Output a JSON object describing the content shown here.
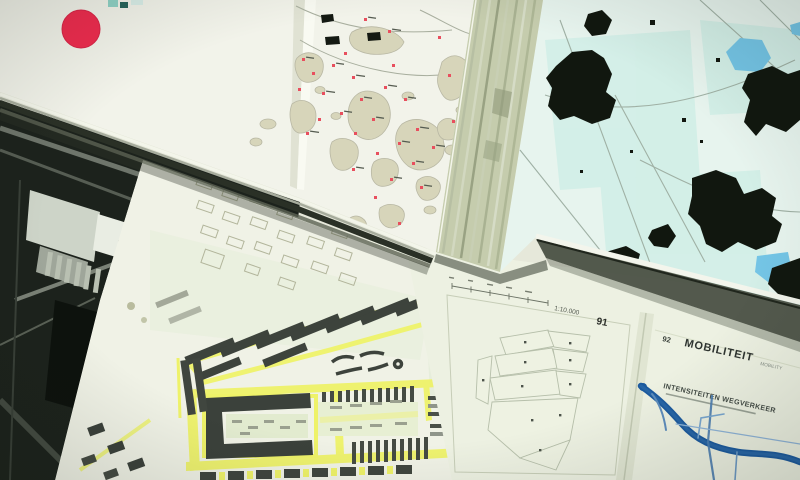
{
  "scene": {
    "description": "Overhead photograph of several overlapping open urban-atlas pages and maps"
  },
  "archipelago_spread": {
    "red_dot_color": "#ee2b4e",
    "island_color": "#d7d5ba",
    "settlement_marker_color": "#e84f5e"
  },
  "topo_map": {
    "background_color": "#e7f4ee",
    "built_up_color": "#11170f",
    "water_color": "#74c5e6"
  },
  "plan_spread": {
    "page_number": "89",
    "highlight_color": "#eef269",
    "building_color": "#3b413b"
  },
  "atlas_spread": {
    "left_page_number": "91",
    "scale_label": "1:10.000",
    "right_page_number": "92",
    "title": "MOBILITEIT",
    "title_small": "MOBILITY",
    "section_heading": "INTENSITEITEN WEGVERKEER",
    "diagram_color": "#1c5a9e"
  }
}
